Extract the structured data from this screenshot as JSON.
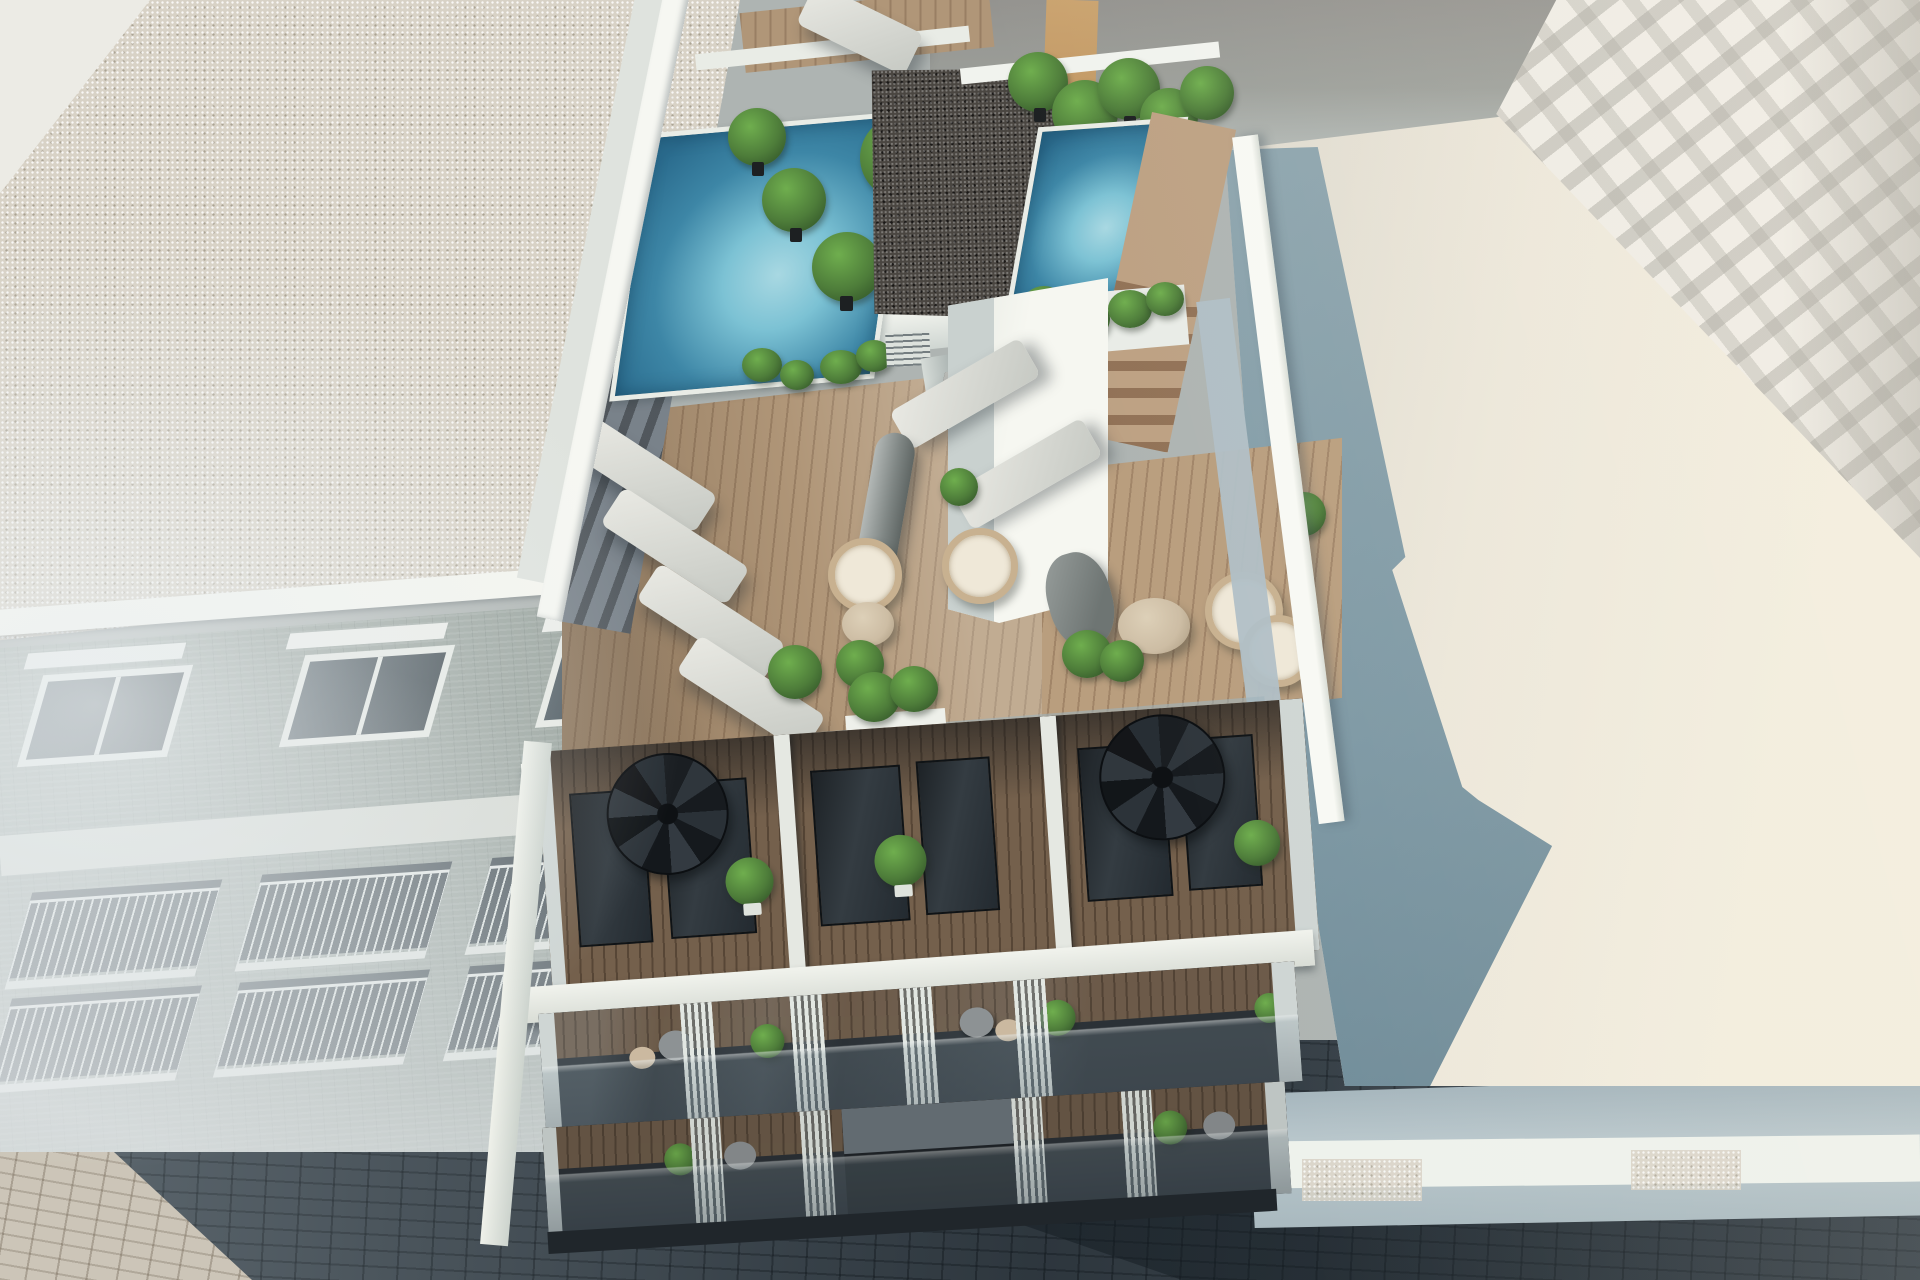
{
  "meta": {
    "type": "3d-architectural-render",
    "width_px": 1920,
    "height_px": 1280,
    "visible_text": "none"
  },
  "scene": {
    "description": "Aerial 3D render of a modern white apartment building: rooftop with two swimming pools, dark gravel core roofs, banana plants, wooden sun deck with loungers, wicker chairs, tables and umbrellas; upper floor terraces with spiral staircases; glass balconies below; flanked by a brick apartment block (left), a tall white building and a flat-roofed neighbor (right); shaded paved street with a sunlit sidewalk corner."
  },
  "objects": {
    "buildings": [
      "left-apartment-building",
      "main-building",
      "right-neighbor-building",
      "right-tall-building"
    ],
    "rooftop": {
      "pools": 2,
      "banana_plants": 9,
      "gravel_roof_sections": 2,
      "roof_vents": 2,
      "wooden_stairs": 2
    },
    "terrace": {
      "sun_loungers": 7,
      "wicker_chairs": 4,
      "round_tables": 2,
      "umbrellas": 2,
      "potted_plants": 6,
      "parapet_planters": 2,
      "small_palms": 2
    },
    "upper_floor": {
      "spiral_staircases": 2,
      "glass_doors": 6,
      "potted_plants": 3
    },
    "balcony_levels": 2,
    "balcony_fin_groups": 4,
    "left_building": {
      "window_row_units": 3,
      "balcony_rows": 2
    },
    "street": {
      "sunlit_sidewalk_corner": true,
      "shaded_road": true
    }
  },
  "colors": {
    "roof_gravel_light": "#d8d2c6",
    "roof_gravel_dark": "#4a4641",
    "brick_facade": "#9aa49e",
    "white_sun": "#f5f6f0",
    "white_shade": "#cfd6d4",
    "pool_deep": "#2a6b8d",
    "pool_mid": "#3d86a6",
    "pool_light": "#a8d8e2",
    "wood_deck": "#b09678",
    "wood_dark": "#74604c",
    "plant_green": "#4e7d3a",
    "plant_green_light": "#6fae4e",
    "street_dark": "#47525a",
    "street_mid": "#5d686f",
    "pavement_sun": "#ccc5b8",
    "glass_dark": "#2b3136",
    "steel_dark": "#1a1e22",
    "neighbor_roof_sun": "#ece7da",
    "neighbor_roof_shadow": "#7d98a4",
    "tall_building": "#efece5",
    "gray_wall": "#94938f",
    "tan_wall": "#c39a66",
    "umbrella_gray": "#7e8583",
    "lounger_light": "#c6c9c3",
    "wicker_tan": "#c8b190",
    "table_wood": "#cdbda4",
    "facade_strip_shade": "#b0bfc6",
    "band_white": "#eef2ec"
  }
}
